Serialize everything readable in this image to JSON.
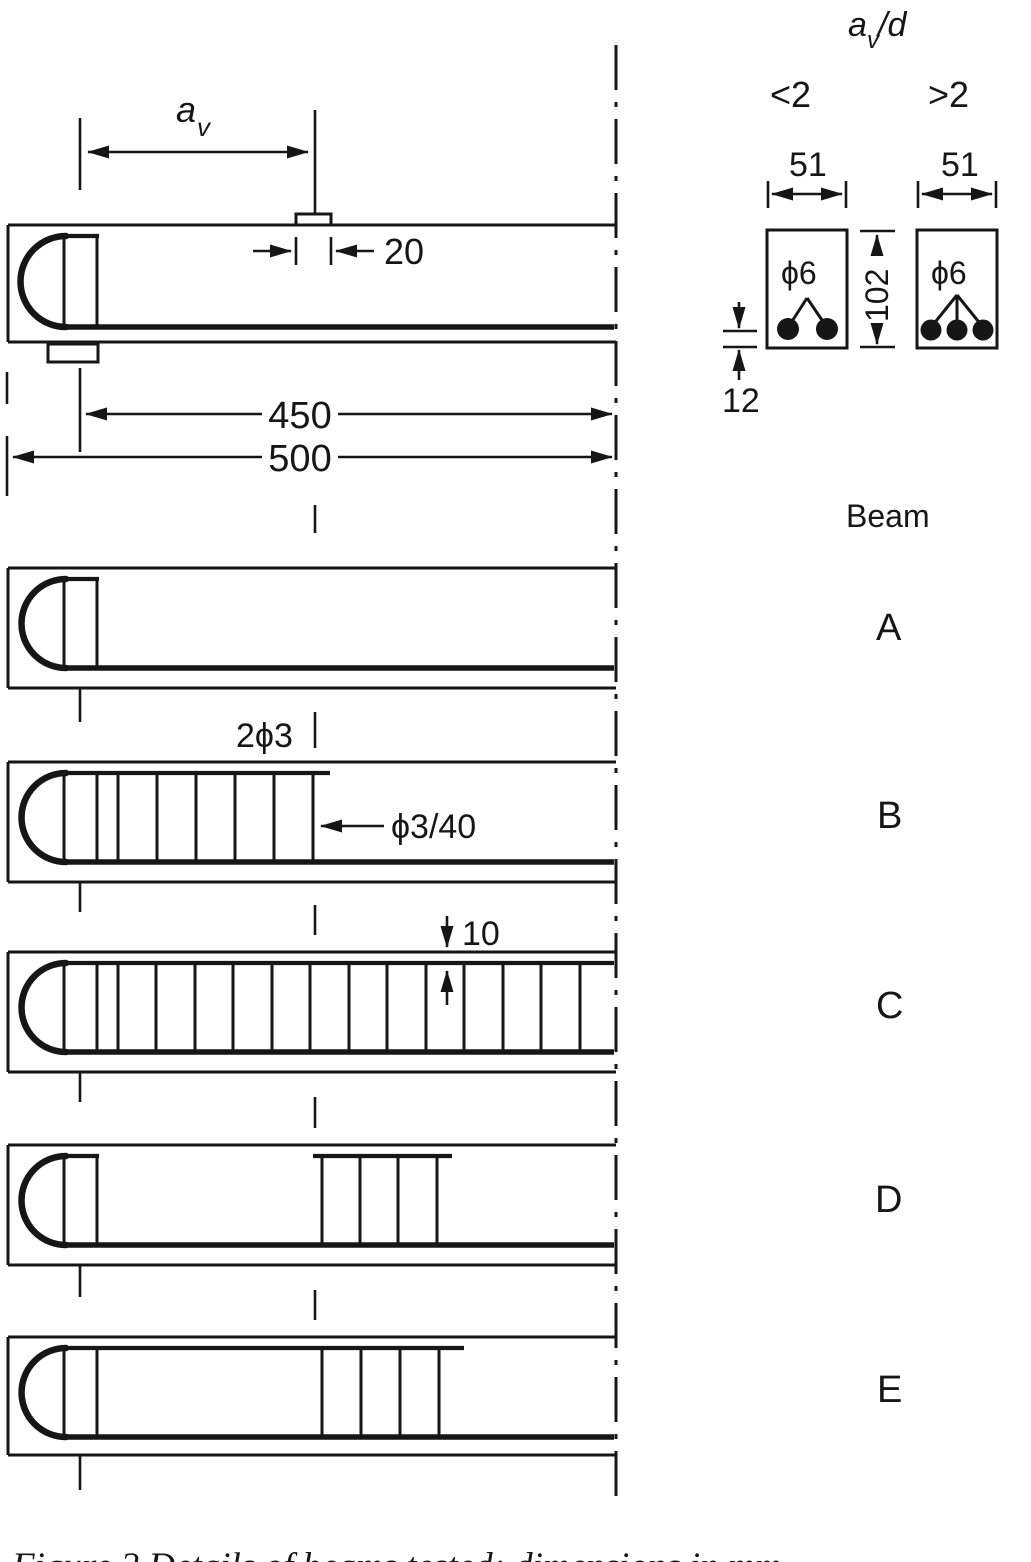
{
  "colors": {
    "ink": "#161616",
    "paper": "#ffffff"
  },
  "elevation": {
    "av": {
      "base": "a",
      "sub": "v"
    },
    "load_plate_width": "20",
    "shear_span_dim": "450",
    "total_length_dim": "500"
  },
  "beam_b_notes": {
    "top_bars": "2ϕ3",
    "stirrup_spec": "ϕ3/40"
  },
  "beam_c_notes": {
    "top_cover": "10"
  },
  "sections": {
    "header": {
      "base": "a",
      "sub": "v",
      "over_d": "/d"
    },
    "left": {
      "ratio": "<2",
      "width": "51",
      "bars": "ϕ6"
    },
    "right": {
      "ratio": ">2",
      "width": "51",
      "bars": "ϕ6"
    },
    "depth": "102",
    "bottom_cover": "12"
  },
  "beam_list": {
    "header": "Beam",
    "rows": [
      {
        "label": "A"
      },
      {
        "label": "B"
      },
      {
        "label": "C"
      },
      {
        "label": "D"
      },
      {
        "label": "E"
      }
    ]
  },
  "caption": "Figure 2   Details of beams tested; dimensions in mm"
}
